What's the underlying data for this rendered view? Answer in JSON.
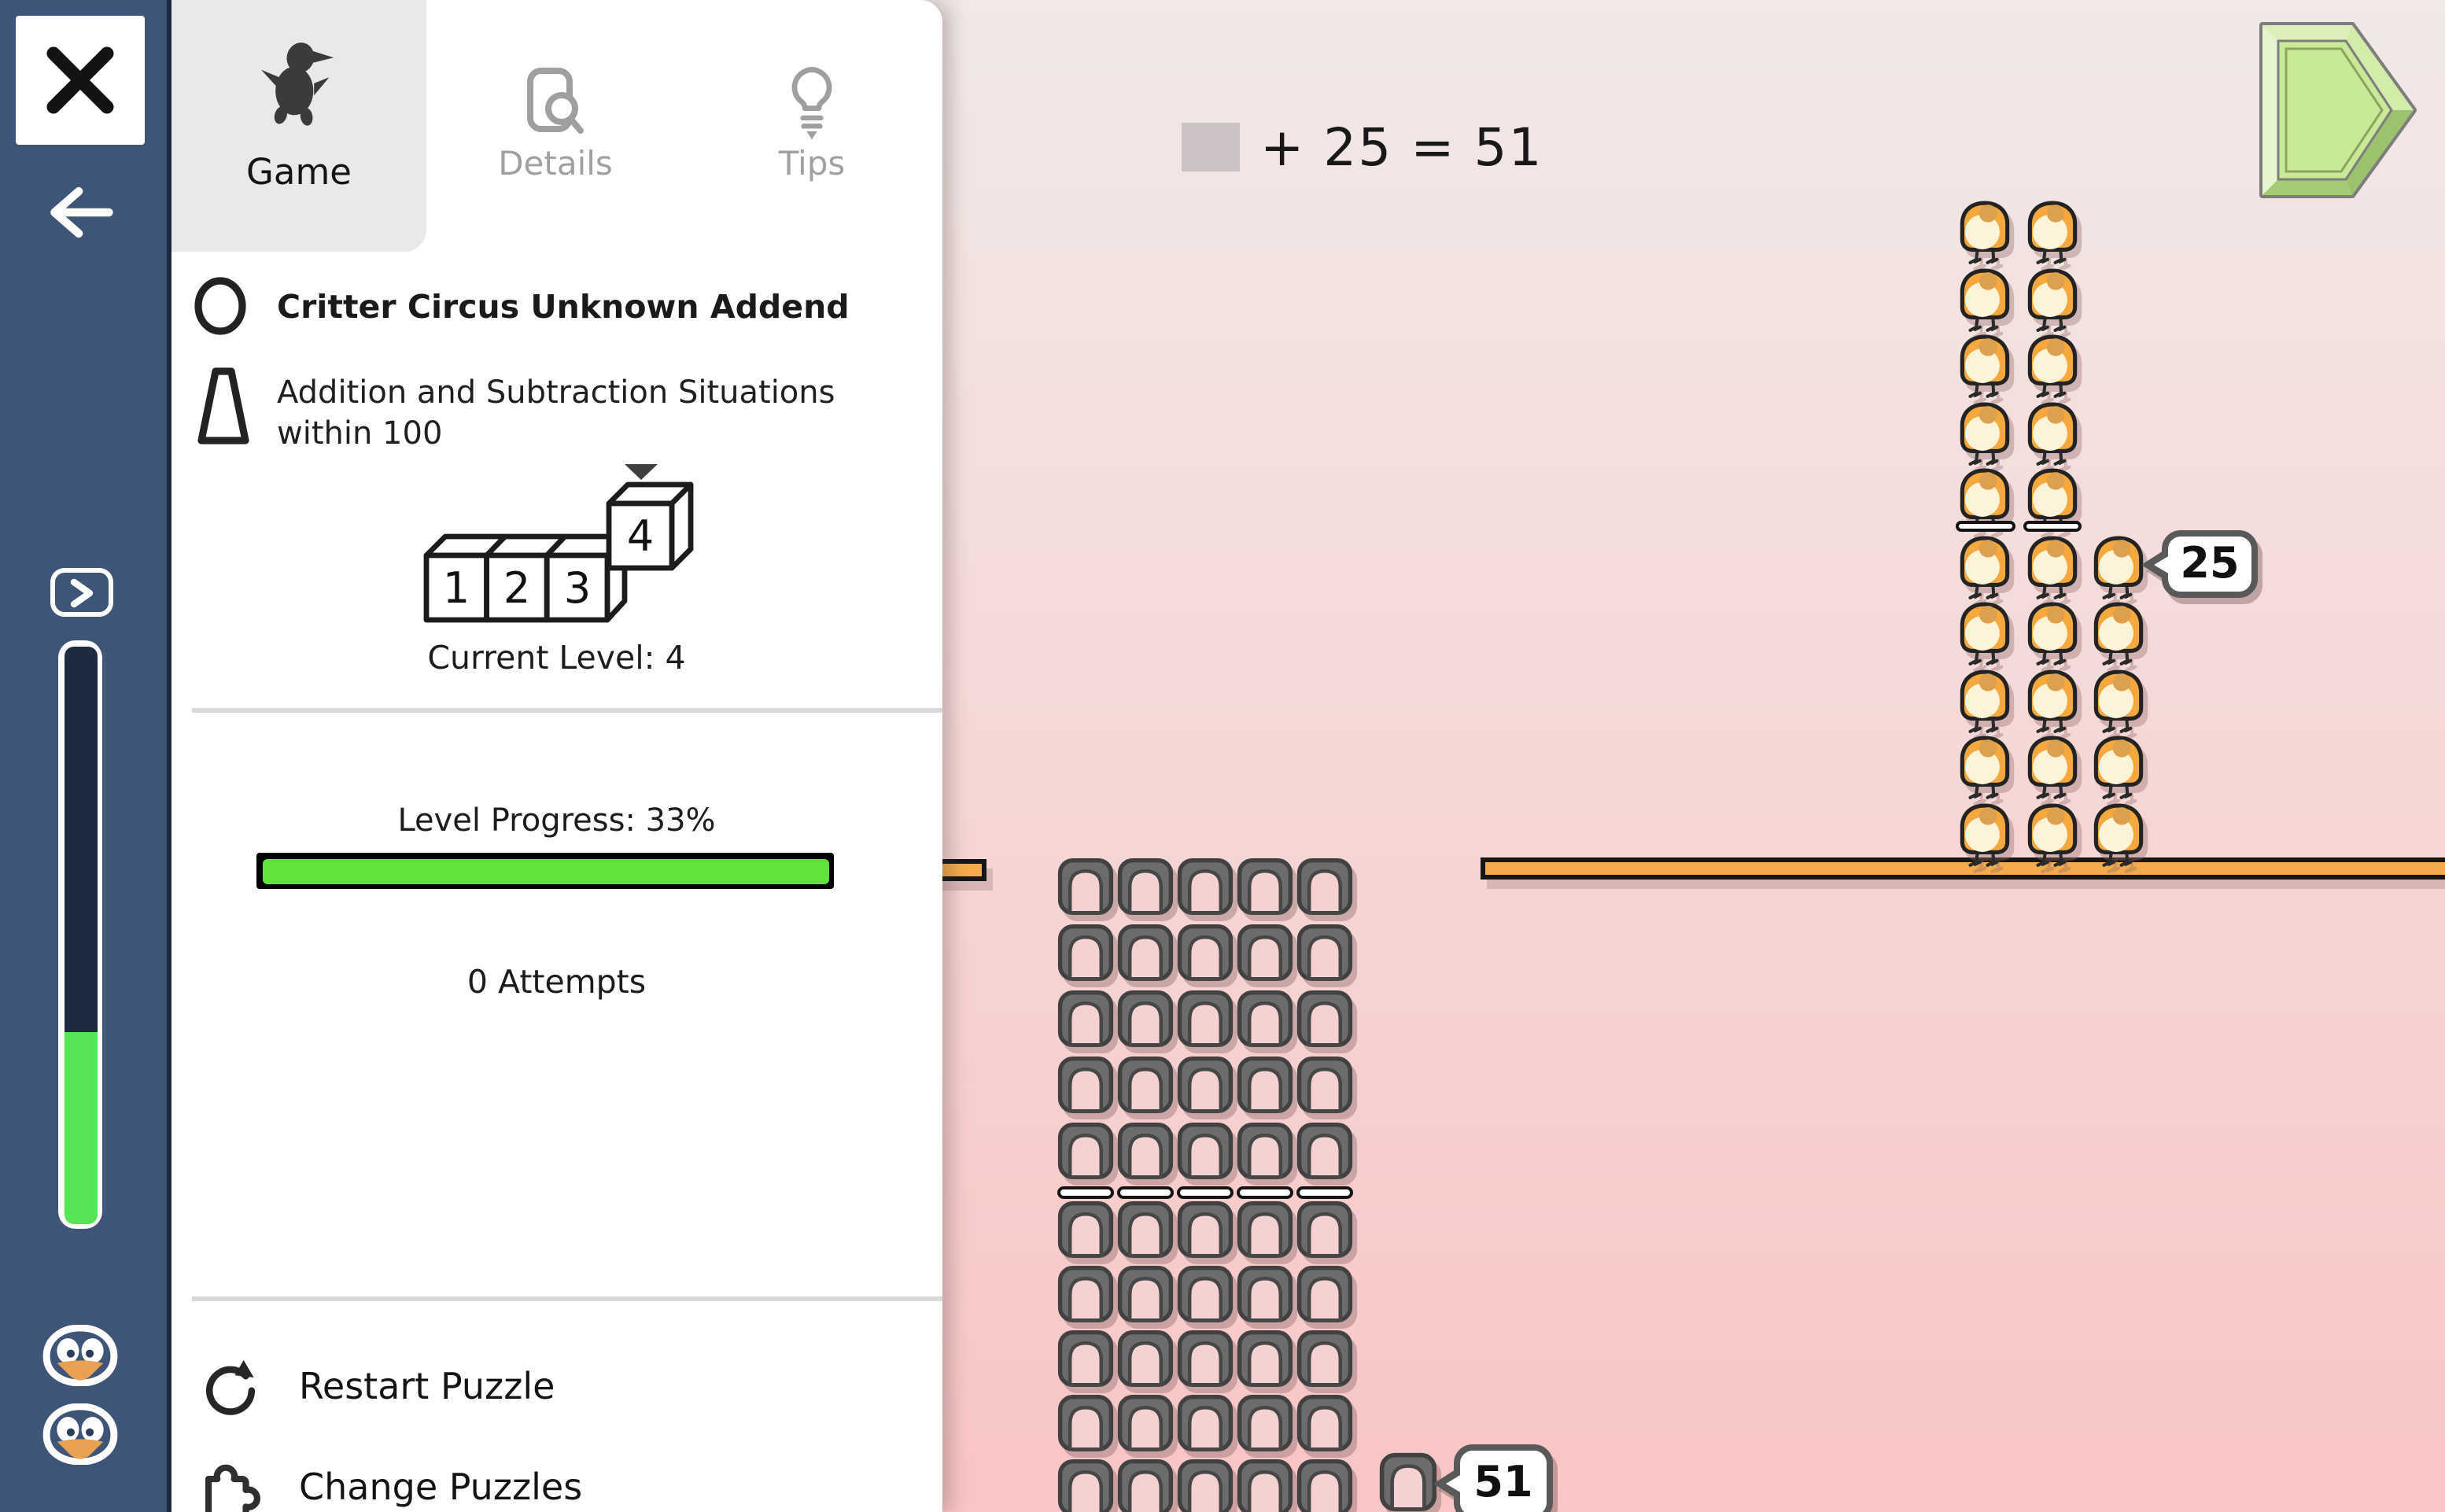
{
  "tabs": [
    {
      "id": "game",
      "label": "Game",
      "active": true
    },
    {
      "id": "details",
      "label": "Details",
      "active": false
    },
    {
      "id": "tips",
      "label": "Tips",
      "active": false
    }
  ],
  "puzzle": {
    "title": "Critter Circus Unknown Addend",
    "standard_line1": "Addition and Subtraction Situations",
    "standard_line2": "within 100",
    "level_map": [
      "1",
      "2",
      "3",
      "4"
    ],
    "current_level_label": "Current Level: 4",
    "progress_label": "Level Progress: 33%",
    "progress_percent": 33,
    "attempts_label": "0 Attempts"
  },
  "menu": {
    "restart_label": "Restart Puzzle",
    "change_label": "Change Puzzles"
  },
  "equation": {
    "text": "+ 25 = 51"
  },
  "game": {
    "critter_count_label": "25",
    "cage_count_label": "51",
    "critter_stack": {
      "columns": [
        10,
        10,
        5
      ],
      "group_size": 5
    },
    "cage_tower": {
      "columns": 5,
      "rows": 10,
      "group_rows": 5,
      "extra_blocks": 1
    }
  },
  "colors": {
    "sidebar": "#3e5577",
    "sidebar_progress_fill": "#55e455",
    "sidebar_progress_track": "#1d2b40",
    "level_progress_fill": "#61e23c",
    "platform": "#f3ab4b",
    "critter_body": "#f4a83e",
    "cage_body": "#6c6c6c",
    "background_top": "#f1e9e7",
    "background_bottom": "#f9c5c5",
    "play_button_face": "#c8ea96"
  }
}
